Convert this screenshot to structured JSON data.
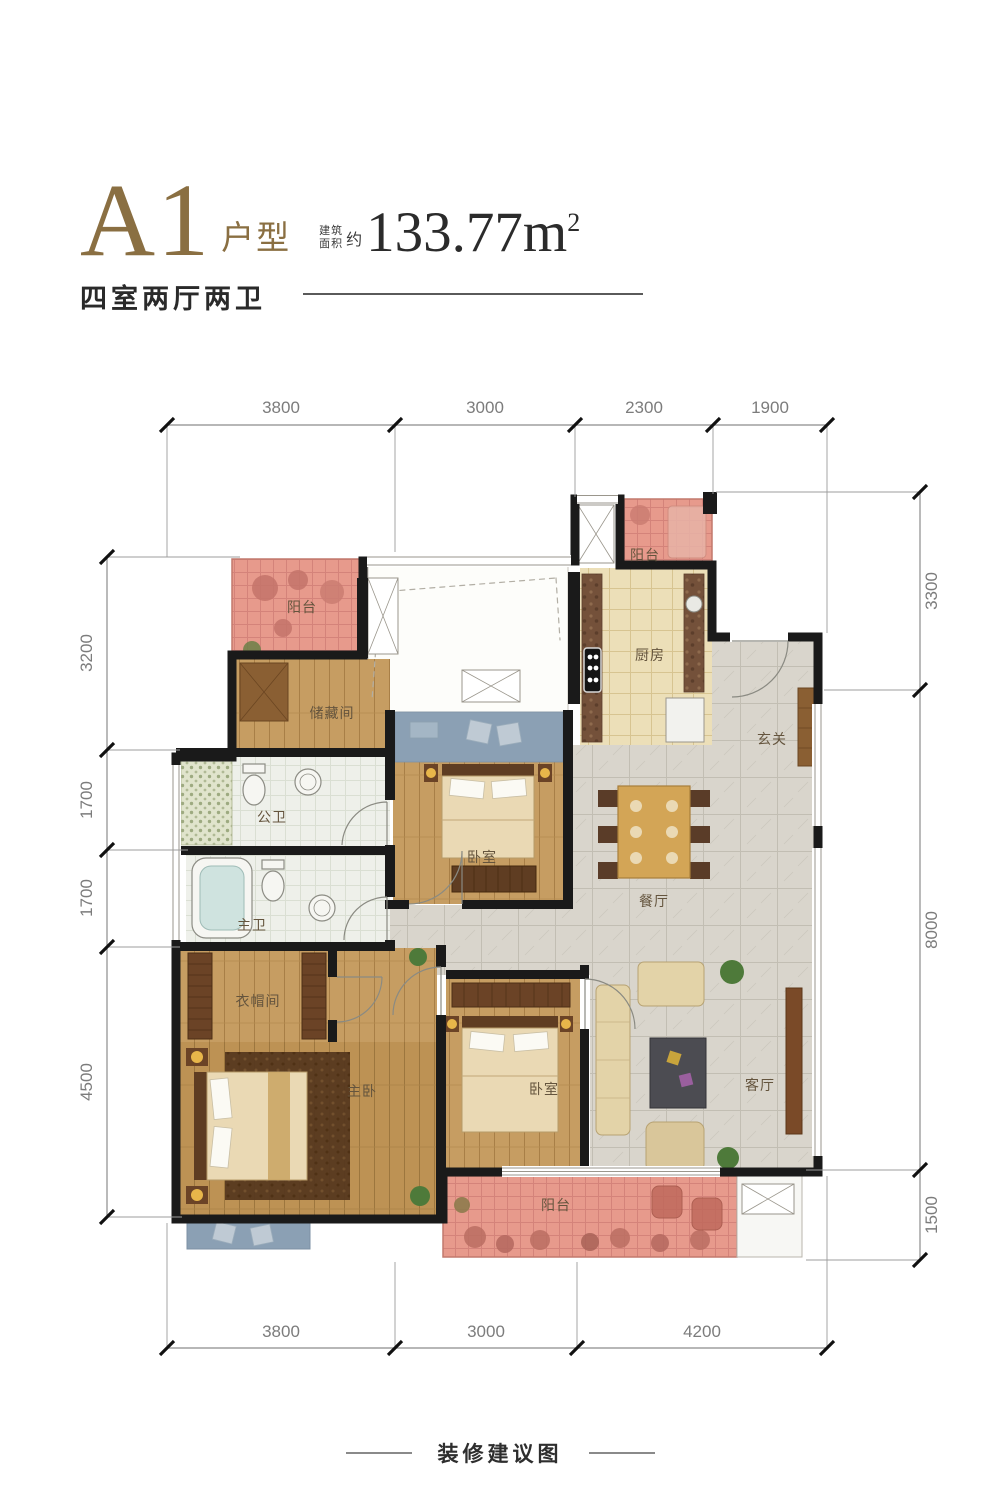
{
  "header": {
    "unit_code": "A1",
    "unit_type_label": "户型",
    "layout_summary": "四室两厅两卫",
    "area_label_line1": "建筑",
    "area_label_line2": "面积",
    "area_approx": "约",
    "area_value": "133.77m",
    "area_superscript": "2"
  },
  "dims": {
    "top": [
      "3800",
      "3000",
      "2300",
      "1900"
    ],
    "bottom": [
      "3800",
      "3000",
      "4200"
    ],
    "left": [
      "3200",
      "1700",
      "1700",
      "4500"
    ],
    "right": [
      "3300",
      "8000",
      "1500"
    ]
  },
  "rooms": {
    "balcony_top_left": "阳台",
    "balcony_top_right": "阳台",
    "storage": "储藏间",
    "kitchen": "厨房",
    "foyer": "玄关",
    "bath_public": "公卫",
    "bath_master": "主卫",
    "bedroom_middle": "卧室",
    "dining": "餐厅",
    "closet": "衣帽间",
    "master_bedroom": "主卧",
    "bedroom_south": "卧室",
    "living": "客厅",
    "balcony_bottom": "阳台"
  },
  "footer": {
    "caption": "装修建议图"
  },
  "colors": {
    "title_gold": "#8a6f42",
    "balcony_pink": "#e79a8c",
    "wood_floor": "#c69d62",
    "bay_window_blue": "#8ba0b4",
    "tile_gray": "#d9d5cc",
    "kitchen_beige": "#ecdfb8",
    "wall_black": "#1a1a1a"
  }
}
